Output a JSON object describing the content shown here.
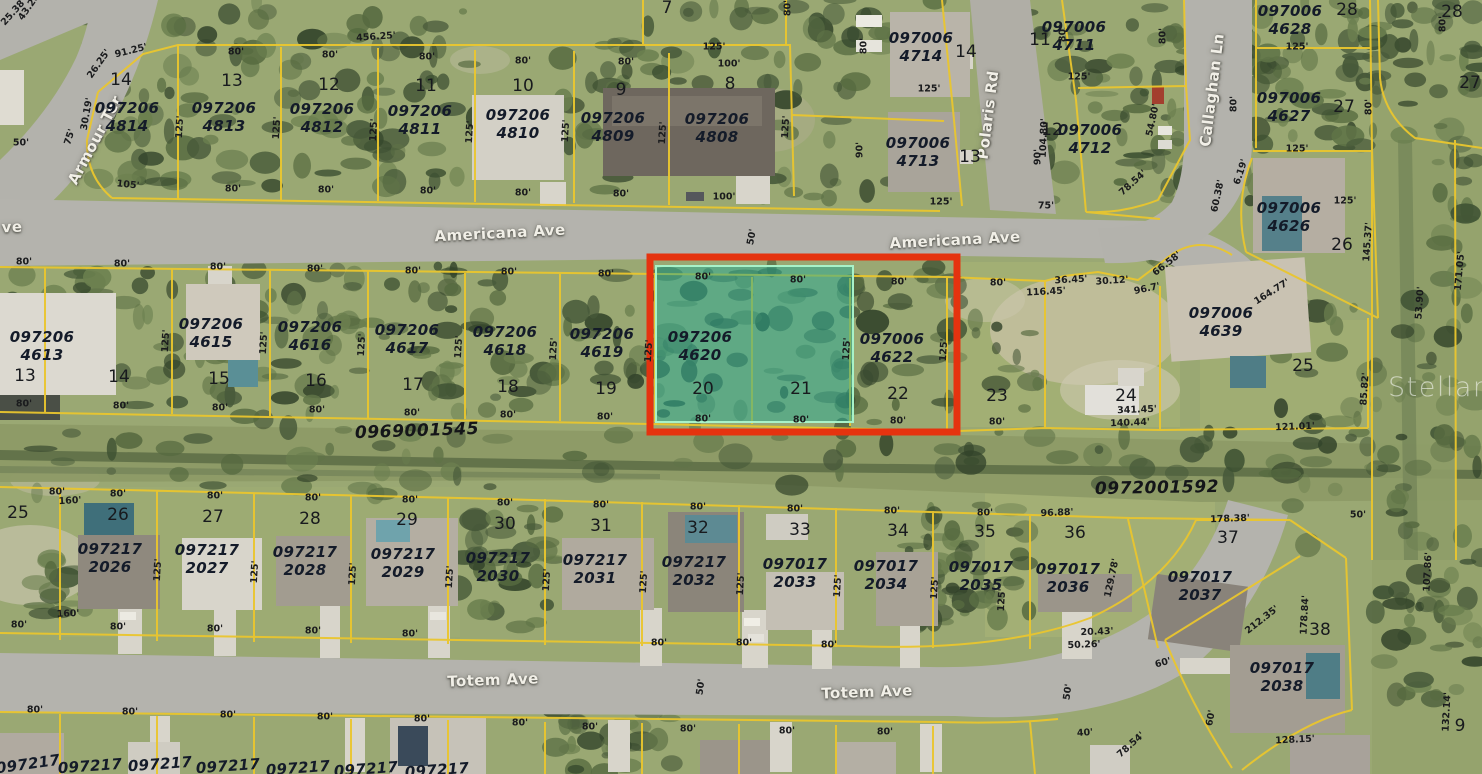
{
  "map": {
    "watermark": "StellarMLS",
    "colors": {
      "parcel_line": "#eac62e",
      "selection_border": "#e5330f",
      "highlight_fill": "rgba(36,170,150,0.5)",
      "highlight_border": "#a8f2c8",
      "label_color": "#141b29",
      "street_text": "#f1efe7"
    },
    "highlight": {
      "parcel_id": "097206 4620",
      "lots": [
        "20",
        "21"
      ]
    },
    "streets": [
      [
        "Armour Ter",
        95,
        140,
        -62
      ],
      [
        "ve",
        12,
        227,
        -2
      ],
      [
        "Americana Ave",
        500,
        233,
        -3
      ],
      [
        "Americana Ave",
        955,
        240,
        -3
      ],
      [
        "Polaris Rd",
        988,
        115,
        -83
      ],
      [
        "Callaghan Ln",
        1212,
        90,
        -83
      ],
      [
        "Totem Ave",
        493,
        680,
        -2
      ],
      [
        "Totem Ave",
        867,
        692,
        -2
      ]
    ],
    "parcel_ids": [
      [
        "097206 4814",
        127,
        117
      ],
      [
        "097206 4813",
        224,
        117
      ],
      [
        "097206 4812",
        322,
        118
      ],
      [
        "097206 4811",
        420,
        120
      ],
      [
        "097206 4810",
        518,
        124
      ],
      [
        "097206 4809",
        613,
        127
      ],
      [
        "097206 4808",
        717,
        128
      ],
      [
        "097006 4714",
        921,
        47
      ],
      [
        "097006 4713",
        918,
        152
      ],
      [
        "097006 4711",
        1074,
        36
      ],
      [
        "097006 4712",
        1090,
        139
      ],
      [
        "097006 4628",
        1290,
        20
      ],
      [
        "097006 4627",
        1289,
        107
      ],
      [
        "097006 4626",
        1289,
        217
      ],
      [
        "097006 4639",
        1221,
        322
      ],
      [
        "097206 4613",
        42,
        346
      ],
      [
        "097206 4615",
        211,
        333
      ],
      [
        "097206 4616",
        310,
        336
      ],
      [
        "097206 4617",
        407,
        339
      ],
      [
        "097206 4618",
        505,
        341
      ],
      [
        "097206 4619",
        602,
        343
      ],
      [
        "097206 4620",
        700,
        346
      ],
      [
        "097006 4622",
        892,
        348
      ],
      [
        "097217 2026",
        110,
        558
      ],
      [
        "097217 2027",
        207,
        559
      ],
      [
        "097217 2028",
        305,
        561
      ],
      [
        "097217 2029",
        403,
        563
      ],
      [
        "097217 2030",
        498,
        567
      ],
      [
        "097217 2031",
        595,
        569
      ],
      [
        "097217 2032",
        694,
        571
      ],
      [
        "097017 2033",
        795,
        573
      ],
      [
        "097017 2034",
        886,
        575
      ],
      [
        "097017 2035",
        981,
        576
      ],
      [
        "097017 2036",
        1068,
        578
      ],
      [
        "097017 2037",
        1200,
        586
      ],
      [
        "097017 2038",
        1282,
        677
      ]
    ],
    "lot_numbers": [
      [
        "14",
        121,
        80
      ],
      [
        "13",
        232,
        81
      ],
      [
        "12",
        329,
        85
      ],
      [
        "11",
        426,
        86
      ],
      [
        "10",
        523,
        86
      ],
      [
        "9",
        621,
        90
      ],
      [
        "8",
        730,
        84
      ],
      [
        "7",
        667,
        8
      ],
      [
        "14",
        966,
        52
      ],
      [
        "13",
        970,
        157
      ],
      [
        "11",
        1040,
        40
      ],
      [
        "12",
        1052,
        130
      ],
      [
        "28",
        1347,
        10
      ],
      [
        "27",
        1344,
        107
      ],
      [
        "26",
        1342,
        245
      ],
      [
        "25",
        1303,
        366
      ],
      [
        "28",
        1452,
        12
      ],
      [
        "27",
        1470,
        83
      ],
      [
        "13",
        25,
        376
      ],
      [
        "14",
        119,
        377
      ],
      [
        "15",
        219,
        379
      ],
      [
        "16",
        316,
        381
      ],
      [
        "17",
        413,
        385
      ],
      [
        "18",
        508,
        387
      ],
      [
        "19",
        606,
        389
      ],
      [
        "20",
        703,
        389
      ],
      [
        "21",
        801,
        389
      ],
      [
        "22",
        898,
        394
      ],
      [
        "23",
        997,
        396
      ],
      [
        "24",
        1126,
        396
      ],
      [
        "25",
        18,
        513
      ],
      [
        "26",
        118,
        515
      ],
      [
        "27",
        213,
        517
      ],
      [
        "28",
        310,
        519
      ],
      [
        "29",
        407,
        520
      ],
      [
        "30",
        505,
        524
      ],
      [
        "31",
        601,
        526
      ],
      [
        "32",
        698,
        528
      ],
      [
        "33",
        800,
        530
      ],
      [
        "34",
        898,
        531
      ],
      [
        "35",
        985,
        532
      ],
      [
        "36",
        1075,
        533
      ],
      [
        "37",
        1228,
        538
      ],
      [
        "38",
        1320,
        630
      ],
      [
        "9",
        1460,
        726
      ]
    ],
    "plat_numbers": [
      [
        "0969001545",
        417,
        431,
        -2
      ],
      [
        "0972001592",
        1157,
        488,
        -1
      ]
    ],
    "dimensions": [
      [
        "25.38'",
        14,
        12,
        -48
      ],
      [
        "43.28'",
        30,
        6,
        -55
      ],
      [
        "50'",
        21,
        143,
        0
      ],
      [
        "91.25'",
        131,
        51,
        -14
      ],
      [
        "26.25'",
        99,
        64,
        -55
      ],
      [
        "30.19'",
        87,
        114,
        -80
      ],
      [
        "75'",
        70,
        137,
        -72
      ],
      [
        "105'",
        128,
        185,
        6
      ],
      [
        "456.25'",
        376,
        37,
        -4
      ],
      [
        "125'",
        180,
        127,
        -87
      ],
      [
        "80'",
        236,
        52,
        0
      ],
      [
        "80'",
        330,
        55,
        0
      ],
      [
        "80'",
        427,
        57,
        0
      ],
      [
        "80'",
        523,
        61,
        0
      ],
      [
        "80'",
        626,
        62,
        0
      ],
      [
        "125'",
        714,
        47,
        0
      ],
      [
        "100'",
        729,
        64,
        0
      ],
      [
        "80'",
        788,
        8,
        -90
      ],
      [
        "125'",
        277,
        128,
        -87
      ],
      [
        "125'",
        374,
        130,
        -87
      ],
      [
        "125'",
        470,
        132,
        -87
      ],
      [
        "125'",
        566,
        131,
        -87
      ],
      [
        "125'",
        663,
        133,
        -87
      ],
      [
        "125'",
        786,
        127,
        -87
      ],
      [
        "80'",
        233,
        189,
        0
      ],
      [
        "80'",
        326,
        190,
        0
      ],
      [
        "80'",
        428,
        191,
        0
      ],
      [
        "80'",
        523,
        193,
        0
      ],
      [
        "80'",
        621,
        194,
        0
      ],
      [
        "100'",
        724,
        197,
        0
      ],
      [
        "50'",
        752,
        237,
        -80
      ],
      [
        "80'",
        864,
        46,
        -90
      ],
      [
        "90'",
        860,
        150,
        -90
      ],
      [
        "125'",
        929,
        89,
        0
      ],
      [
        "125'",
        941,
        202,
        0
      ],
      [
        "80'",
        1063,
        34,
        -90
      ],
      [
        "104.80'",
        1044,
        138,
        -88
      ],
      [
        "90'",
        1038,
        157,
        -90
      ],
      [
        "125'",
        1079,
        77,
        0
      ],
      [
        "75'",
        1046,
        206,
        0
      ],
      [
        "54.80'",
        1153,
        120,
        -78
      ],
      [
        "78.54'",
        1133,
        183,
        -42
      ],
      [
        "125'",
        1345,
        201,
        0
      ],
      [
        "80'",
        1163,
        36,
        -90
      ],
      [
        "125'",
        1297,
        47,
        0
      ],
      [
        "80'",
        1234,
        104,
        -90
      ],
      [
        "80'",
        1369,
        107,
        -90
      ],
      [
        "125'",
        1297,
        149,
        0
      ],
      [
        "6.19'",
        1241,
        172,
        -72
      ],
      [
        "60.38'",
        1218,
        196,
        -78
      ],
      [
        "145.37'",
        1368,
        242,
        -86
      ],
      [
        "171.05'",
        1460,
        271,
        -85
      ],
      [
        "80'",
        1443,
        24,
        -90
      ],
      [
        "66.58'",
        1167,
        264,
        -38
      ],
      [
        "96.7'",
        1147,
        289,
        -12
      ],
      [
        "30.12'",
        1112,
        281,
        -4
      ],
      [
        "36.45'",
        1071,
        280,
        -3
      ],
      [
        "116.45'",
        1046,
        292,
        -3
      ],
      [
        "164.77'",
        1272,
        292,
        -32
      ],
      [
        "80'",
        998,
        283,
        0
      ],
      [
        "80'",
        24,
        262,
        0
      ],
      [
        "80'",
        122,
        264,
        0
      ],
      [
        "80'",
        218,
        267,
        0
      ],
      [
        "80'",
        315,
        269,
        0
      ],
      [
        "80'",
        413,
        271,
        0
      ],
      [
        "80'",
        509,
        272,
        0
      ],
      [
        "80'",
        606,
        274,
        0
      ],
      [
        "80'",
        703,
        277,
        0
      ],
      [
        "80'",
        798,
        280,
        0
      ],
      [
        "80'",
        899,
        282,
        0
      ],
      [
        "125'",
        166,
        341,
        -87
      ],
      [
        "125'",
        264,
        343,
        -87
      ],
      [
        "125'",
        362,
        345,
        -87
      ],
      [
        "125'",
        459,
        347,
        -87
      ],
      [
        "125'",
        554,
        349,
        -87
      ],
      [
        "125'",
        649,
        351,
        -87
      ],
      [
        "125'",
        847,
        349,
        -87
      ],
      [
        "125'",
        944,
        350,
        -87
      ],
      [
        "80'",
        24,
        404,
        0
      ],
      [
        "80'",
        121,
        406,
        0
      ],
      [
        "80'",
        220,
        408,
        0
      ],
      [
        "80'",
        317,
        410,
        0
      ],
      [
        "80'",
        412,
        413,
        0
      ],
      [
        "80'",
        508,
        415,
        0
      ],
      [
        "80'",
        605,
        417,
        0
      ],
      [
        "80'",
        703,
        419,
        0
      ],
      [
        "80'",
        801,
        420,
        0
      ],
      [
        "80'",
        898,
        421,
        0
      ],
      [
        "80'",
        997,
        422,
        0
      ],
      [
        "341.45'",
        1137,
        410,
        -2
      ],
      [
        "140.44'",
        1130,
        423,
        -2
      ],
      [
        "121.01'",
        1295,
        427,
        -2
      ],
      [
        "85.82'",
        1365,
        389,
        -86
      ],
      [
        "53.90'",
        1420,
        303,
        -86
      ],
      [
        "80'",
        57,
        492,
        0
      ],
      [
        "160'",
        70,
        501,
        -3
      ],
      [
        "80'",
        118,
        494,
        0
      ],
      [
        "80'",
        215,
        496,
        0
      ],
      [
        "80'",
        313,
        498,
        0
      ],
      [
        "80'",
        410,
        500,
        0
      ],
      [
        "80'",
        505,
        503,
        0
      ],
      [
        "80'",
        601,
        505,
        0
      ],
      [
        "80'",
        698,
        507,
        0
      ],
      [
        "80'",
        795,
        509,
        0
      ],
      [
        "80'",
        892,
        511,
        0
      ],
      [
        "80'",
        985,
        513,
        0
      ],
      [
        "96.88'",
        1057,
        513,
        -2
      ],
      [
        "178.38'",
        1230,
        519,
        -2
      ],
      [
        "50'",
        1358,
        515,
        0
      ],
      [
        "125'",
        158,
        570,
        -87
      ],
      [
        "125'",
        255,
        572,
        -87
      ],
      [
        "125'",
        353,
        574,
        -87
      ],
      [
        "125'",
        450,
        577,
        -87
      ],
      [
        "125'",
        547,
        580,
        -87
      ],
      [
        "125'",
        644,
        582,
        -87
      ],
      [
        "125'",
        741,
        584,
        -87
      ],
      [
        "125'",
        838,
        586,
        -87
      ],
      [
        "125'",
        935,
        588,
        -87
      ],
      [
        "125'",
        1002,
        600,
        -87
      ],
      [
        "129.78'",
        1112,
        578,
        -78
      ],
      [
        "160'",
        68,
        614,
        -2
      ],
      [
        "80'",
        19,
        625,
        0
      ],
      [
        "80'",
        118,
        627,
        0
      ],
      [
        "80'",
        215,
        629,
        0
      ],
      [
        "80'",
        313,
        631,
        0
      ],
      [
        "80'",
        410,
        634,
        0
      ],
      [
        "80'",
        659,
        643,
        0
      ],
      [
        "80'",
        744,
        643,
        0
      ],
      [
        "80'",
        829,
        645,
        0
      ],
      [
        "20.43'",
        1097,
        632,
        -2
      ],
      [
        "50.26'",
        1084,
        645,
        -2
      ],
      [
        "60'",
        1163,
        663,
        -15
      ],
      [
        "80'",
        35,
        710,
        0
      ],
      [
        "80'",
        130,
        712,
        0
      ],
      [
        "80'",
        228,
        715,
        0
      ],
      [
        "80'",
        325,
        717,
        0
      ],
      [
        "80'",
        422,
        719,
        0
      ],
      [
        "80'",
        520,
        723,
        0
      ],
      [
        "80'",
        590,
        727,
        0
      ],
      [
        "80'",
        688,
        729,
        0
      ],
      [
        "80'",
        787,
        731,
        0
      ],
      [
        "80'",
        885,
        732,
        0
      ],
      [
        "50'",
        701,
        687,
        -82
      ],
      [
        "50'",
        1068,
        692,
        -82
      ],
      [
        "40'",
        1085,
        733,
        -4
      ],
      [
        "78.54'",
        1131,
        745,
        -42
      ],
      [
        "60'",
        1211,
        718,
        -80
      ],
      [
        "128.15'",
        1295,
        740,
        -3
      ],
      [
        "212.35'",
        1262,
        620,
        -38
      ],
      [
        "178.84'",
        1305,
        615,
        -87
      ],
      [
        "132.14'",
        1447,
        712,
        -87
      ],
      [
        "107.86'",
        1428,
        572,
        -87
      ]
    ],
    "partial_labels": [
      [
        "097217",
        28,
        764,
        -8
      ],
      [
        "097217",
        90,
        766,
        -4
      ],
      [
        "097217",
        160,
        764,
        -4
      ],
      [
        "097217",
        228,
        766,
        -4
      ],
      [
        "097217",
        298,
        768,
        -4
      ],
      [
        "097217",
        366,
        769,
        -4
      ],
      [
        "097217",
        437,
        770,
        -4
      ]
    ]
  }
}
